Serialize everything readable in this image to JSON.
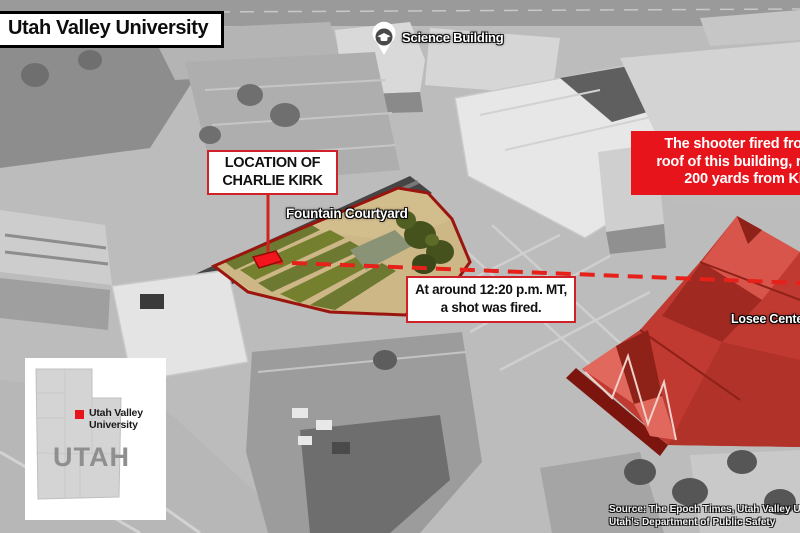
{
  "title": "Utah Valley University",
  "map_labels": {
    "science_building": "Science Building",
    "fountain_courtyard": "Fountain Courtyard",
    "losee_center": "Losee Center"
  },
  "callouts": {
    "kirk_location": {
      "line1": "LOCATION OF",
      "line2": "CHARLIE KIRK"
    },
    "shot_time": {
      "line1": "At around 12:20 p.m. MT,",
      "line2": "a shot was fired."
    },
    "shooter": {
      "line1": "The shooter fired from the",
      "line2": "roof of this building, roughly",
      "line3": "200 yards from Kirk."
    }
  },
  "inset_map": {
    "state_label": "UTAH",
    "marker_label_line1": "Utah Valley",
    "marker_label_line2": "University"
  },
  "source": {
    "line1": "Source: The Epoch Times, Utah Valley University,",
    "line2": "Utah's Department of Public Safety"
  },
  "colors": {
    "accent_red": "#e8141c",
    "callout_border_red": "#cf2127",
    "courtyard_outline": "#9b150f",
    "trajectory_red": "#e6211a"
  }
}
